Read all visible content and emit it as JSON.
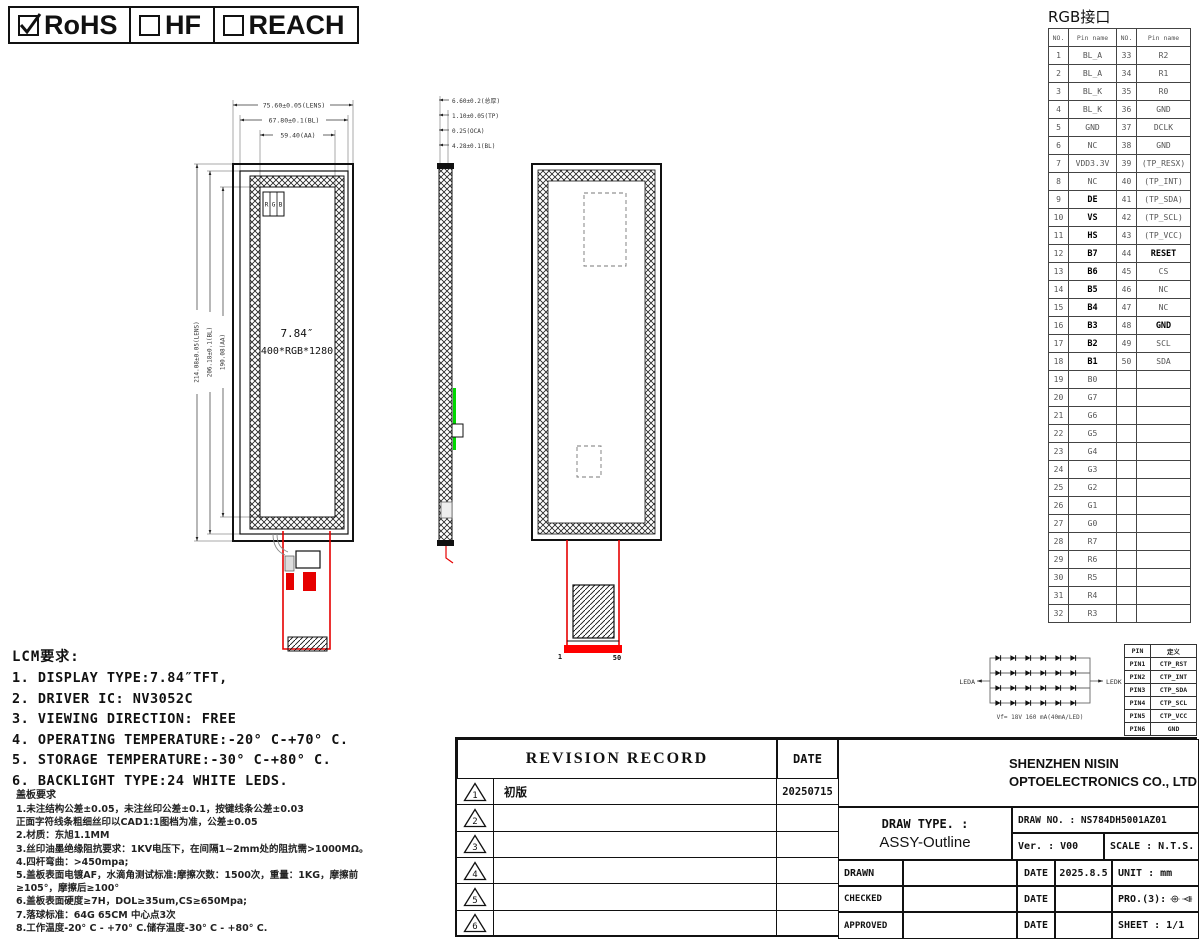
{
  "compliance": {
    "items": [
      {
        "label": "RoHS",
        "checked": true
      },
      {
        "label": "HF",
        "checked": false
      },
      {
        "label": "REACH",
        "checked": false
      }
    ]
  },
  "rgb_interface": {
    "title": "RGB接口",
    "headers": [
      "NO.",
      "Pin name",
      "NO.",
      "Pin name"
    ],
    "rows": [
      {
        "no1": "1",
        "name1": "BL_A",
        "no2": "33",
        "name2": "R2"
      },
      {
        "no1": "2",
        "name1": "BL_A",
        "no2": "34",
        "name2": "R1"
      },
      {
        "no1": "3",
        "name1": "BL_K",
        "no2": "35",
        "name2": "R0"
      },
      {
        "no1": "4",
        "name1": "BL_K",
        "no2": "36",
        "name2": "GND"
      },
      {
        "no1": "5",
        "name1": "GND",
        "no2": "37",
        "name2": "DCLK"
      },
      {
        "no1": "6",
        "name1": "NC",
        "no2": "38",
        "name2": "GND"
      },
      {
        "no1": "7",
        "name1": "VDD3.3V",
        "no2": "39",
        "name2": "(TP_RESX)"
      },
      {
        "no1": "8",
        "name1": "NC",
        "no2": "40",
        "name2": "(TP_INT)"
      },
      {
        "no1": "9",
        "name1": "DE",
        "b1": true,
        "no2": "41",
        "name2": "(TP_SDA)"
      },
      {
        "no1": "10",
        "name1": "VS",
        "b1": true,
        "no2": "42",
        "name2": "(TP_SCL)"
      },
      {
        "no1": "11",
        "name1": "HS",
        "b1": true,
        "no2": "43",
        "name2": "(TP_VCC)"
      },
      {
        "no1": "12",
        "name1": "B7",
        "b1": true,
        "no2": "44",
        "name2": "RESET",
        "b2": true
      },
      {
        "no1": "13",
        "name1": "B6",
        "b1": true,
        "no2": "45",
        "name2": "CS"
      },
      {
        "no1": "14",
        "name1": "B5",
        "b1": true,
        "no2": "46",
        "name2": "NC"
      },
      {
        "no1": "15",
        "name1": "B4",
        "b1": true,
        "no2": "47",
        "name2": "NC"
      },
      {
        "no1": "16",
        "name1": "B3",
        "b1": true,
        "no2": "48",
        "name2": "GND",
        "b2": true
      },
      {
        "no1": "17",
        "name1": "B2",
        "b1": true,
        "no2": "49",
        "name2": "SCL"
      },
      {
        "no1": "18",
        "name1": "B1",
        "b1": true,
        "no2": "50",
        "name2": "SDA"
      },
      {
        "no1": "19",
        "name1": "B0",
        "no2": "",
        "name2": ""
      },
      {
        "no1": "20",
        "name1": "G7",
        "no2": "",
        "name2": ""
      },
      {
        "no1": "21",
        "name1": "G6",
        "no2": "",
        "name2": ""
      },
      {
        "no1": "22",
        "name1": "G5",
        "no2": "",
        "name2": ""
      },
      {
        "no1": "23",
        "name1": "G4",
        "no2": "",
        "name2": ""
      },
      {
        "no1": "24",
        "name1": "G3",
        "no2": "",
        "name2": ""
      },
      {
        "no1": "25",
        "name1": "G2",
        "no2": "",
        "name2": ""
      },
      {
        "no1": "26",
        "name1": "G1",
        "no2": "",
        "name2": ""
      },
      {
        "no1": "27",
        "name1": "G0",
        "no2": "",
        "name2": ""
      },
      {
        "no1": "28",
        "name1": "R7",
        "no2": "",
        "name2": ""
      },
      {
        "no1": "29",
        "name1": "R6",
        "no2": "",
        "name2": ""
      },
      {
        "no1": "30",
        "name1": "R5",
        "no2": "",
        "name2": ""
      },
      {
        "no1": "31",
        "name1": "R4",
        "no2": "",
        "name2": ""
      },
      {
        "no1": "32",
        "name1": "R3",
        "no2": "",
        "name2": ""
      }
    ]
  },
  "ctp_pins": {
    "headers": [
      "PIN",
      "定义"
    ],
    "rows": [
      [
        "PIN1",
        "CTP_RST"
      ],
      [
        "PIN2",
        "CTP_INT"
      ],
      [
        "PIN3",
        "CTP_SDA"
      ],
      [
        "PIN4",
        "CTP_SCL"
      ],
      [
        "PIN5",
        "CTP_VCC"
      ],
      [
        "PIN6",
        "GND"
      ]
    ]
  },
  "led_diagram": {
    "left_label": "LEDA",
    "right_label": "LEDK",
    "caption": "Vf= 18V  160 mA(40mA/LED)",
    "rows": 4,
    "leds_per_row": 6
  },
  "front_view": {
    "dims_top": [
      "75.60±0.05(LENS)",
      "67.80±0.1(BL)",
      "59.40(AA)"
    ],
    "dims_left": [
      "214.08±0.05(LENS)",
      "206.18±0.1(BL)",
      "190.08(AA)"
    ],
    "screen_size": "7.84″",
    "resolution": "400*RGB*1280",
    "rgb_marker": [
      "R",
      "G",
      "B"
    ]
  },
  "side_view": {
    "dims": [
      "6.60±0.2(总厚)",
      "1.10±0.05(TP)",
      "0.25(OCA)",
      "4.28±0.1(BL)"
    ]
  },
  "rear_view": {
    "pin_first": "1",
    "pin_last": "50"
  },
  "lcm_requirements": {
    "title": "LCM要求:",
    "items": [
      "1. DISPLAY TYPE:7.84″TFT,",
      "2. DRIVER IC: NV3052C",
      "3. VIEWING DIRECTION: FREE",
      "4. OPERATING TEMPERATURE:-20° C-+70° C.",
      "5. STORAGE TEMPERATURE:-30° C-+80° C.",
      "6. BACKLIGHT TYPE:24 WHITE LEDS."
    ]
  },
  "cover_requirements": {
    "title": "盖板要求",
    "lines": [
      "1.未注结构公差±0.05，未注丝印公差±0.1，按键线条公差±0.03",
      "正面字符线条粗细丝印以CAD1:1图档为准，公差±0.05",
      "2.材质：东旭1.1MM",
      "3.丝印油墨绝缘阻抗要求：1KV电压下，在间隔1~2mm处的阻抗需>1000MΩ。",
      "4.四杆弯曲：>450mpa;",
      "5.盖板表面电镀AF，水滴角测试标准:摩擦次数：1500次，重量：1KG，摩擦前",
      "≥105°，摩擦后≥100°",
      "6.盖板表面硬度≥7H，DOL≥35um,CS≥650Mpa;",
      "7.落球标准：64G 65CM 中心点3次",
      "8.工作温度-20° C - +70° C.储存温度-30° C - +80° C."
    ]
  },
  "revision": {
    "header": "REVISION RECORD",
    "date_header": "DATE",
    "rows": [
      {
        "no": "1",
        "desc": "初版",
        "date": "20250715"
      },
      {
        "no": "2",
        "desc": "",
        "date": ""
      },
      {
        "no": "3",
        "desc": "",
        "date": ""
      },
      {
        "no": "4",
        "desc": "",
        "date": ""
      },
      {
        "no": "5",
        "desc": "",
        "date": ""
      },
      {
        "no": "6",
        "desc": "",
        "date": ""
      }
    ]
  },
  "title_block": {
    "company_line1": "SHENZHEN NISIN",
    "company_line2": "OPTOELECTRONICS CO., LTD",
    "draw_type_label": "DRAW TYPE. :",
    "draw_type_value": "ASSY-Outline",
    "draw_no": "DRAW NO. : NS784DH5001AZ01",
    "ver": "Ver. :  V00",
    "scale": "SCALE : N.T.S.",
    "drawn_label": "DRAWN",
    "checked_label": "CHECKED",
    "approved_label": "APPROVED",
    "date_label": "DATE",
    "drawn_date": "2025.8.5",
    "unit": "UNIT : mm",
    "projection_label": "PRO.(3):",
    "sheet": "SHEET :  1/1"
  }
}
